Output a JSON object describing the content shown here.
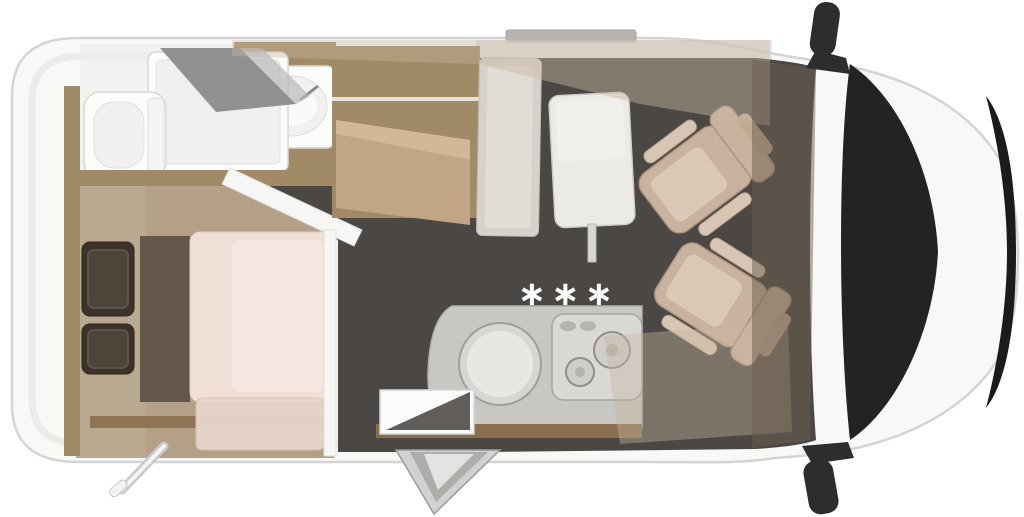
{
  "floorplan": {
    "heater_marker": "∗∗∗"
  },
  "palette": {
    "body": "#f8f8f7",
    "body_edge": "#d4d4d6",
    "wall_inner": "#ebebea",
    "roof_strip": "#b7b4b1",
    "floor": "#4a4745",
    "wood_dark": "#8a6f4f",
    "wood_mid": "#a18a66",
    "wood_light": "#b3a087",
    "seat": "#c9b39e",
    "seat_face": "#dbc9b7",
    "bed": "#f0dfd7",
    "bed_light": "#f4e7e0",
    "bench": "#e8d4c9",
    "pillow": "#3c342c",
    "pillow_inner": "#4d443a",
    "counter": "#c8c7c4",
    "counter_edge": "#b0afac",
    "shower_glass": "#919193",
    "overhead": "#c9b7a1",
    "dash": "#6b5d4d",
    "glass": "#232323",
    "grille": "#1b1b1b",
    "mirror": "#2d2d2d"
  }
}
